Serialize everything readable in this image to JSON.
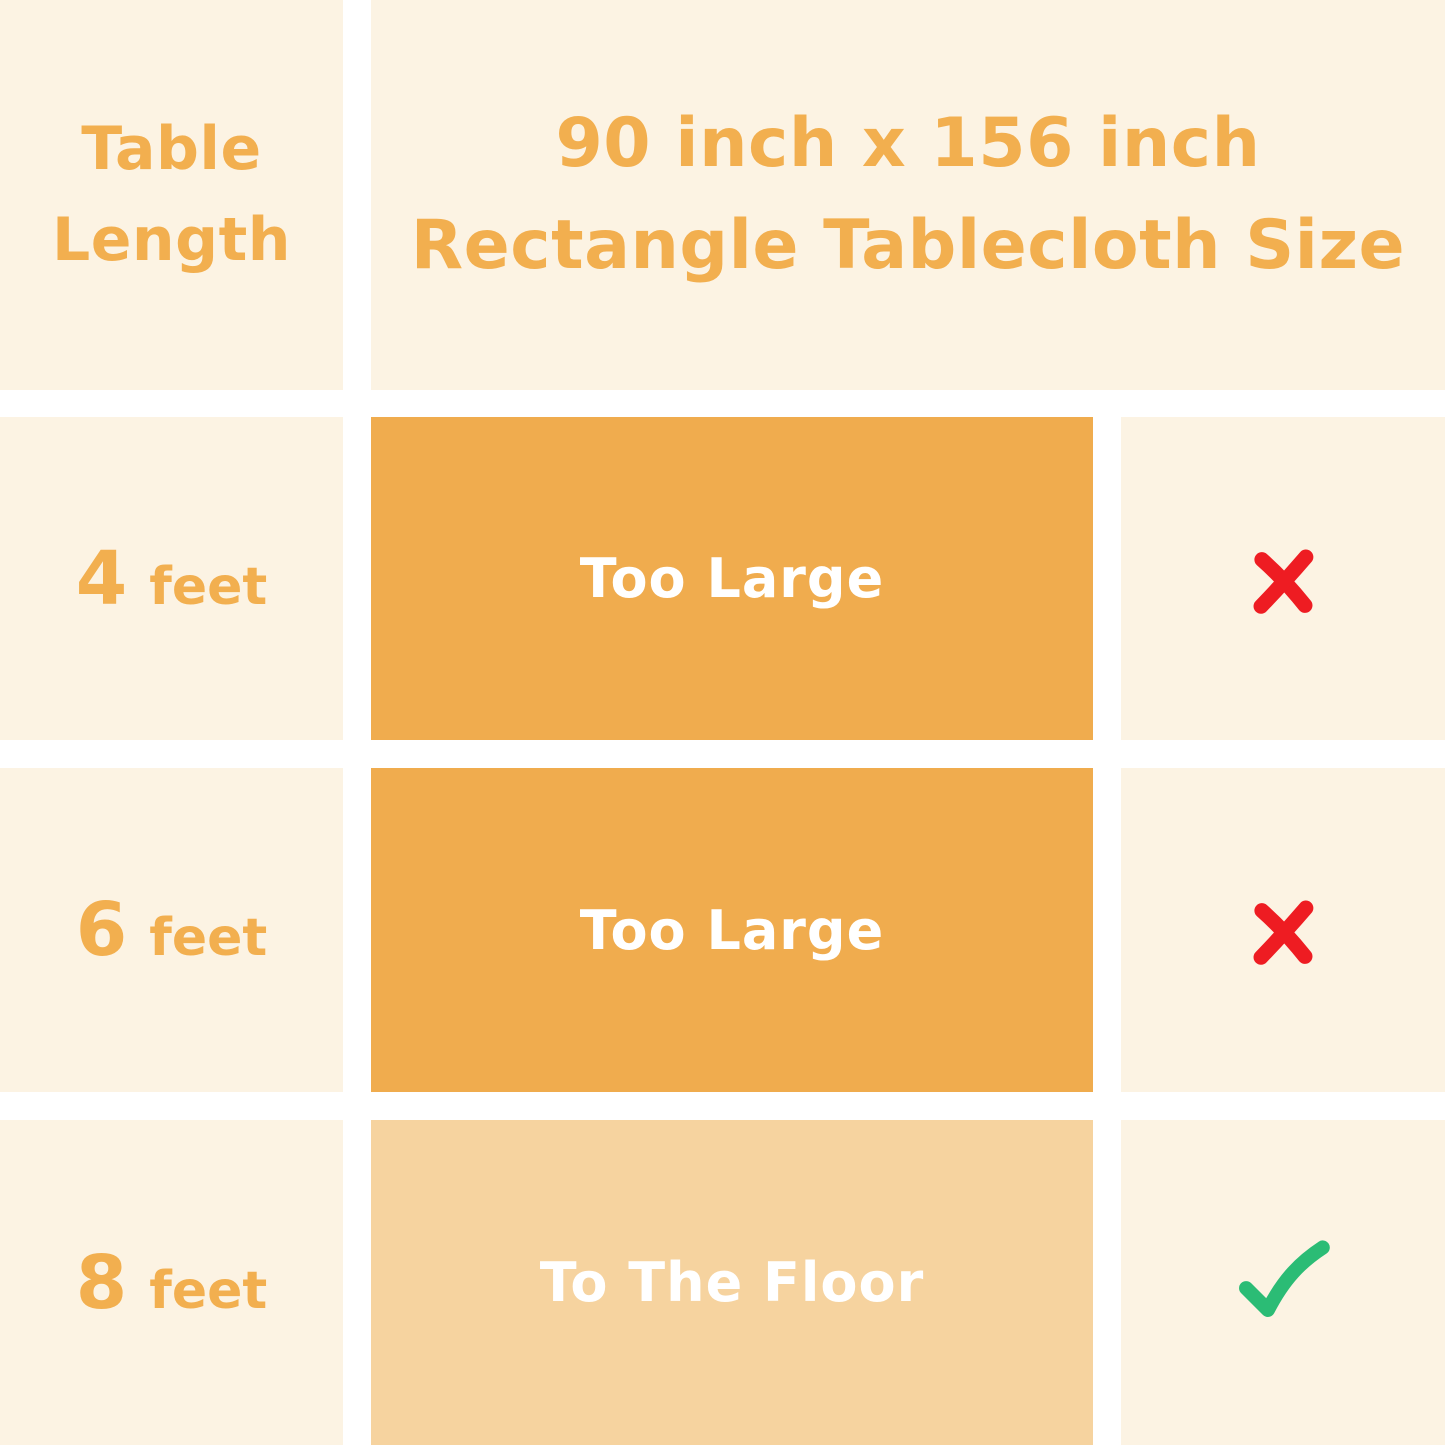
{
  "chart_data": {
    "type": "table",
    "title": "90 inch x 156 inch Rectangle Tablecloth Size",
    "columns": [
      "Table Length",
      "90 inch x 156 inch Rectangle Tablecloth Size",
      ""
    ],
    "rows": [
      {
        "table_length": "4 feet",
        "coverage": "Too Large",
        "suitable": false
      },
      {
        "table_length": "6 feet",
        "coverage": "Too Large",
        "suitable": false
      },
      {
        "table_length": "8 feet",
        "coverage": "To The Floor",
        "suitable": true
      }
    ],
    "layout": "grid table with white gutters, header row spans coverage and verdict columns"
  },
  "header": {
    "row_label_line1": "Table",
    "row_label_line2": "Length",
    "title_line1": "90 inch x 156 inch",
    "title_line2": "Rectangle Tablecloth Size"
  },
  "rows": [
    {
      "length_value": "4",
      "length_unit": "feet",
      "coverage_label": "Too Large",
      "verdict": "unsuitable",
      "verdict_icon": "red-x-icon"
    },
    {
      "length_value": "6",
      "length_unit": "feet",
      "coverage_label": "Too Large",
      "verdict": "unsuitable",
      "verdict_icon": "red-x-icon"
    },
    {
      "length_value": "8",
      "length_unit": "feet",
      "coverage_label": "To The Floor",
      "verdict": "suitable",
      "verdict_icon": "green-check-icon"
    }
  ],
  "colors": {
    "background": "#FFFFFF",
    "cell-cream": "#FCF3E3",
    "bar-orange": "#F0AC4E",
    "bar-orange-light": "#F6D39F",
    "accent-text": "#F2AF4F",
    "bar-text": "#FFFFFF",
    "cross-red": "#EE1C22",
    "check-green": "#2BBC75"
  }
}
